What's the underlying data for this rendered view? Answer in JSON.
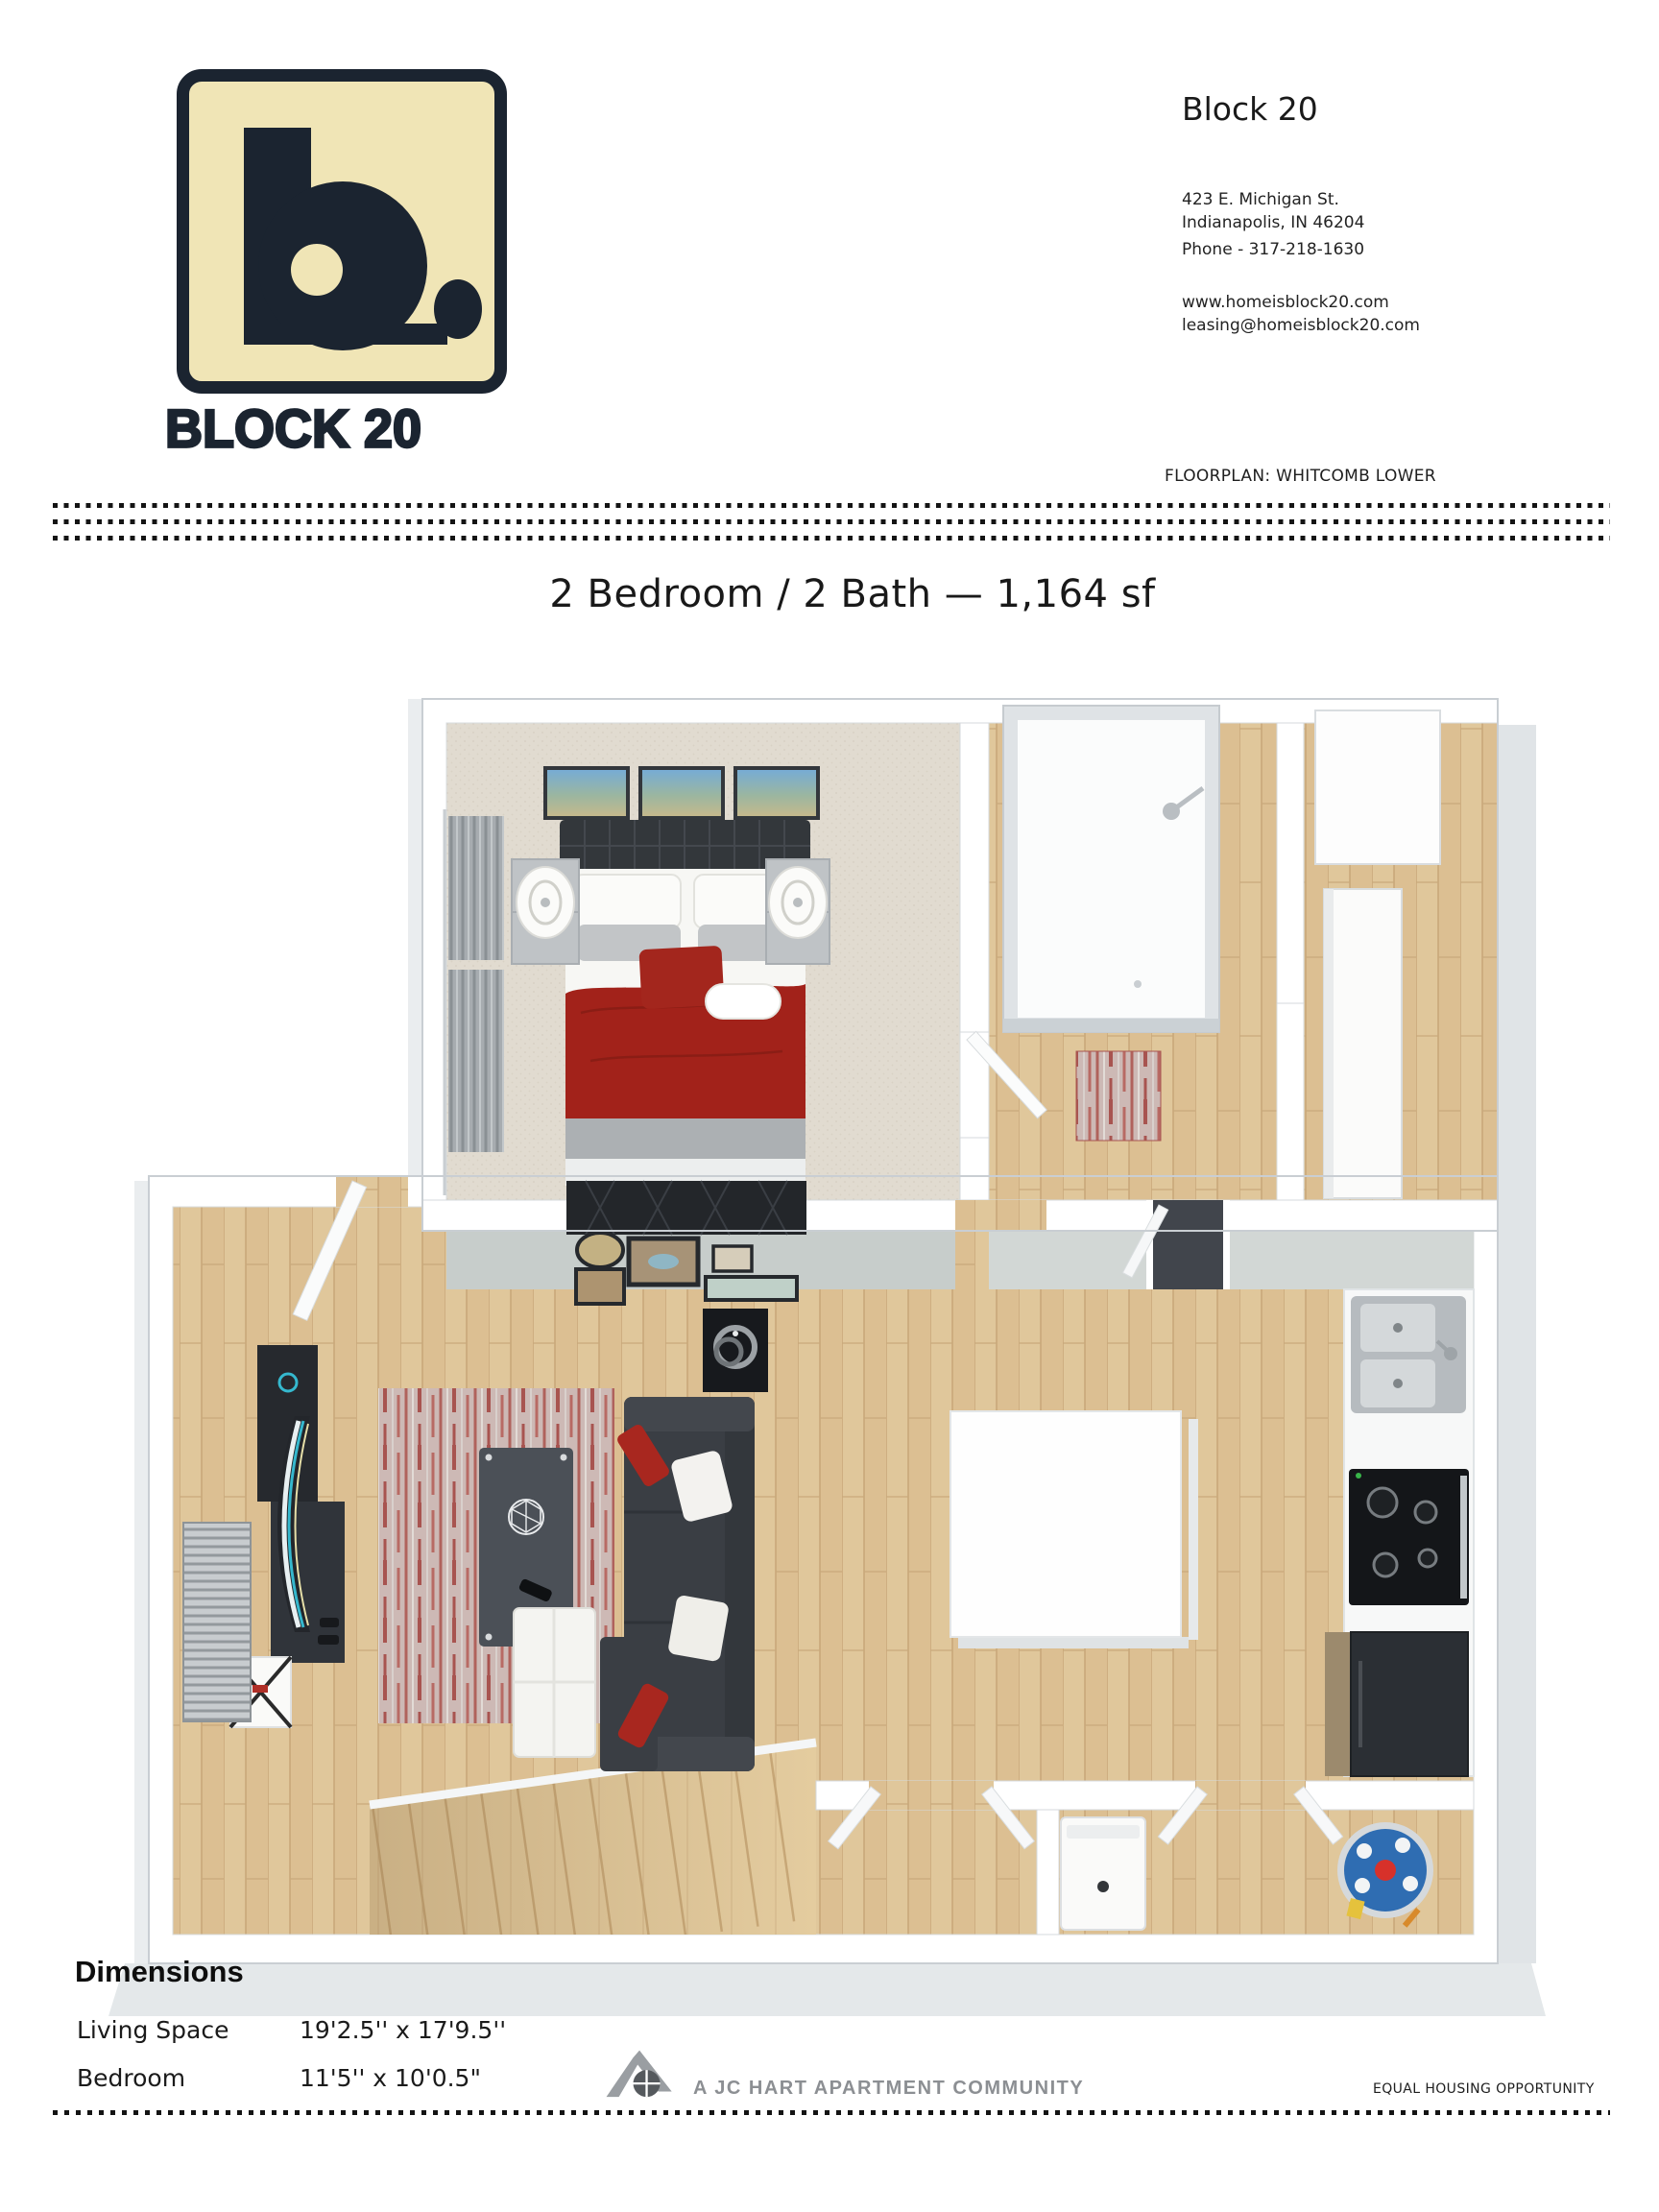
{
  "header": {
    "property_name": "Block 20",
    "address_line1": "423 E. Michigan St.",
    "address_line2": "Indianapolis, IN 46204",
    "phone": "Phone - 317-218-1630",
    "website": "www.homeisblock20.com",
    "email": "leasing@homeisblock20.com",
    "floorplan_label": "FLOORPLAN: WHITCOMB LOWER"
  },
  "logo": {
    "wordmark": "BLOCK 20",
    "monogram": "b."
  },
  "title": "2 Bedroom / 2 Bath — 1,164 sf",
  "dimensions": {
    "heading": "Dimensions",
    "rows": [
      {
        "label": "Living Space",
        "value": "19'2.5'' x 17'9.5''"
      },
      {
        "label": "Bedroom",
        "value": "11'5'' x 10'0.5\""
      }
    ]
  },
  "footer": {
    "community_label": "A JC HART APARTMENT COMMUNITY",
    "equal_housing_label": "EQUAL HOUSING OPPORTUNITY"
  },
  "floorplan": {
    "rooms": [
      "Bedroom",
      "Bathroom",
      "Walk-in Closet",
      "Living Room",
      "Kitchen",
      "Laundry",
      "Hallway",
      "Stairs"
    ],
    "colors": {
      "logo_cream": "#F0E5B6",
      "logo_navy": "#1B2430",
      "wood_floor": "#DCBF92",
      "bedroom_carpet": "#E1DBD0",
      "accent_red": "#A2221A",
      "sofa_charcoal": "#3A3E44",
      "water_heater_blue": "#2F6DB2"
    }
  }
}
